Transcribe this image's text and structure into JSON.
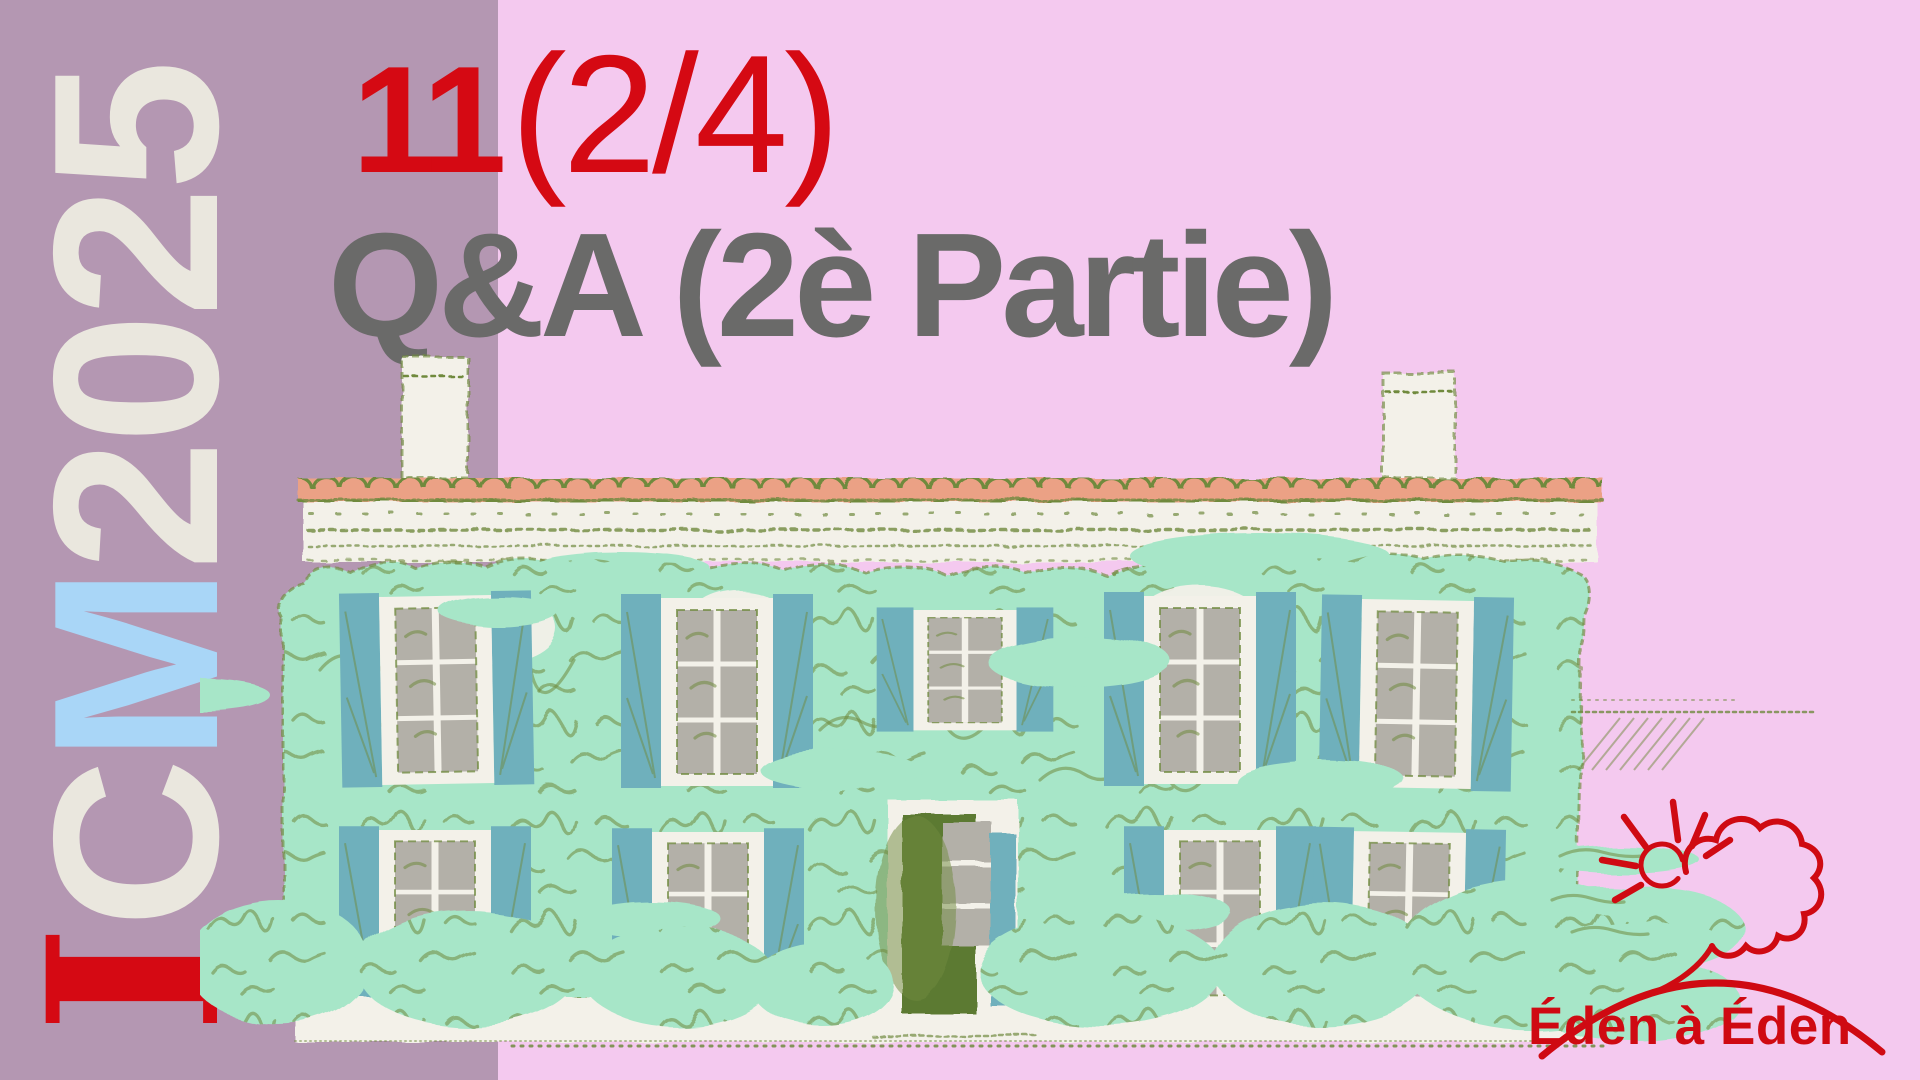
{
  "header": {
    "episode_number": "11",
    "episode_part": "(2/4)",
    "title": "Q&A (2è Partie)"
  },
  "sidebar": {
    "brand": {
      "i": "I",
      "c": "C",
      "m": "M",
      "year": "2025",
      "full": "ICM2025"
    }
  },
  "logo": {
    "text": "Éden à Éden",
    "icons": [
      "sun-icon",
      "cloud-icon",
      "hill-arc-icon"
    ]
  },
  "illustration": {
    "alt": "Hand-drawn stone house covered in mint ivy, teal shutters, salmon tiled roof, bushes"
  },
  "colors": {
    "sidebar_mauve": "#b497b2",
    "background_pink": "#f4c9ef",
    "accent_red": "#d50913",
    "title_gray": "#6a6a69",
    "brand_cream": "#eae7de",
    "brand_blue": "#a9d6f7",
    "ivy_mint": "#a7e6c8",
    "sketch_olive": "#6f8a3e",
    "shutter_teal": "#6fb0bc",
    "roof_salmon": "#eba185",
    "wall_cream": "#f3f1e9",
    "glass_gray": "#b3b0a8",
    "door_olive": "#5c7a33",
    "logo_red": "#cf0a12"
  }
}
